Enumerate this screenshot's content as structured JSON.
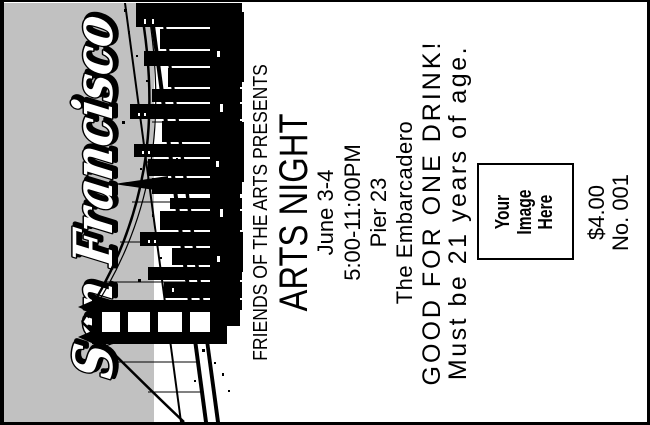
{
  "ticket": {
    "city_title": "San Francisco",
    "presenter": "FRIENDS OF THE ARTS PRESENTS",
    "event_title": "ARTS NIGHT",
    "date": "June 3-4",
    "time": "5:00-11:00PM",
    "venue": "Pier 23",
    "location": "The Embarcadero",
    "perk": "GOOD FOR ONE DRINK!",
    "age_restriction": "Must be 21 years of age.",
    "image_placeholder": {
      "lines": [
        "Your",
        "Image",
        "Here"
      ]
    },
    "price": "$4.00",
    "serial": "No. 001",
    "orientation": "text rotated 90deg counterclockwise",
    "art": {
      "name": "san-francisco-skyline-bay-bridge-silhouette",
      "style": "black-and-white"
    },
    "colors": {
      "panel_gray": "#c1c1c1",
      "ink": "#000000",
      "paper": "#ffffff"
    }
  }
}
